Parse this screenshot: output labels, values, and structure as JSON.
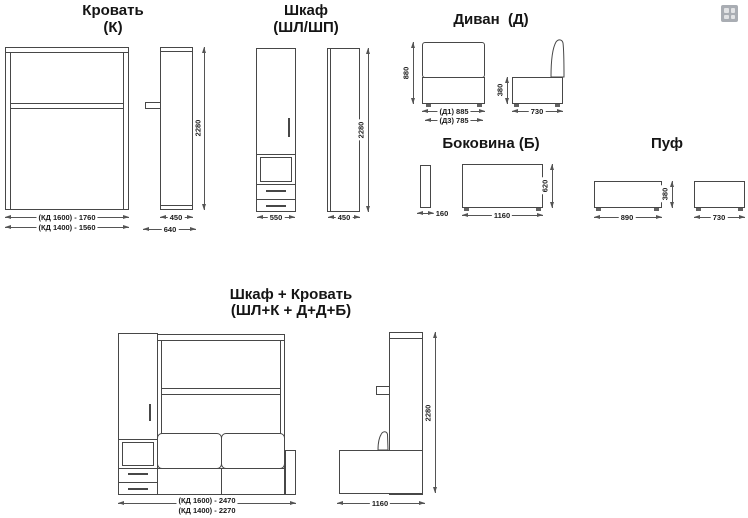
{
  "colors": {
    "line": "#474747",
    "dim": "#555555",
    "text": "#1b1b1b",
    "background": "#ffffff",
    "icon_bg": "#a9adb3",
    "icon_square": "#e2e3e5"
  },
  "toolbar": {
    "grid_icon": "grid-thumbnails"
  },
  "bed": {
    "title": "Кровать",
    "code": "(К)",
    "width_dim_1": "(КД 1600) - 1760",
    "width_dim_2": "(КД 1400) - 1560",
    "height": "2280",
    "side_width": "450",
    "side_depth": "640"
  },
  "wardrobe": {
    "title": "Шкаф",
    "code": "(ШЛ/ШП)",
    "front_width": "550",
    "side_width": "450",
    "height": "2280"
  },
  "sofa": {
    "title": "Диван  (Д)",
    "front_height": "880",
    "width_dim_1": "(Д1) 885",
    "width_dim_2": "(Д3) 785",
    "side_height": "380",
    "side_width": "730"
  },
  "side_panel": {
    "title": "Боковина (Б)",
    "thickness": "160",
    "height": "620",
    "width": "1160"
  },
  "pouf": {
    "title": "Пуф",
    "height": "380",
    "front_width": "890",
    "side_width": "730"
  },
  "combo": {
    "title": "Шкаф + Кровать",
    "code": "(ШЛ+К + Д+Д+Б)",
    "width_dim_1": "(КД 1600) - 2470",
    "width_dim_2": "(КД 1400) - 2270",
    "height": "2280",
    "side_width": "1160"
  }
}
